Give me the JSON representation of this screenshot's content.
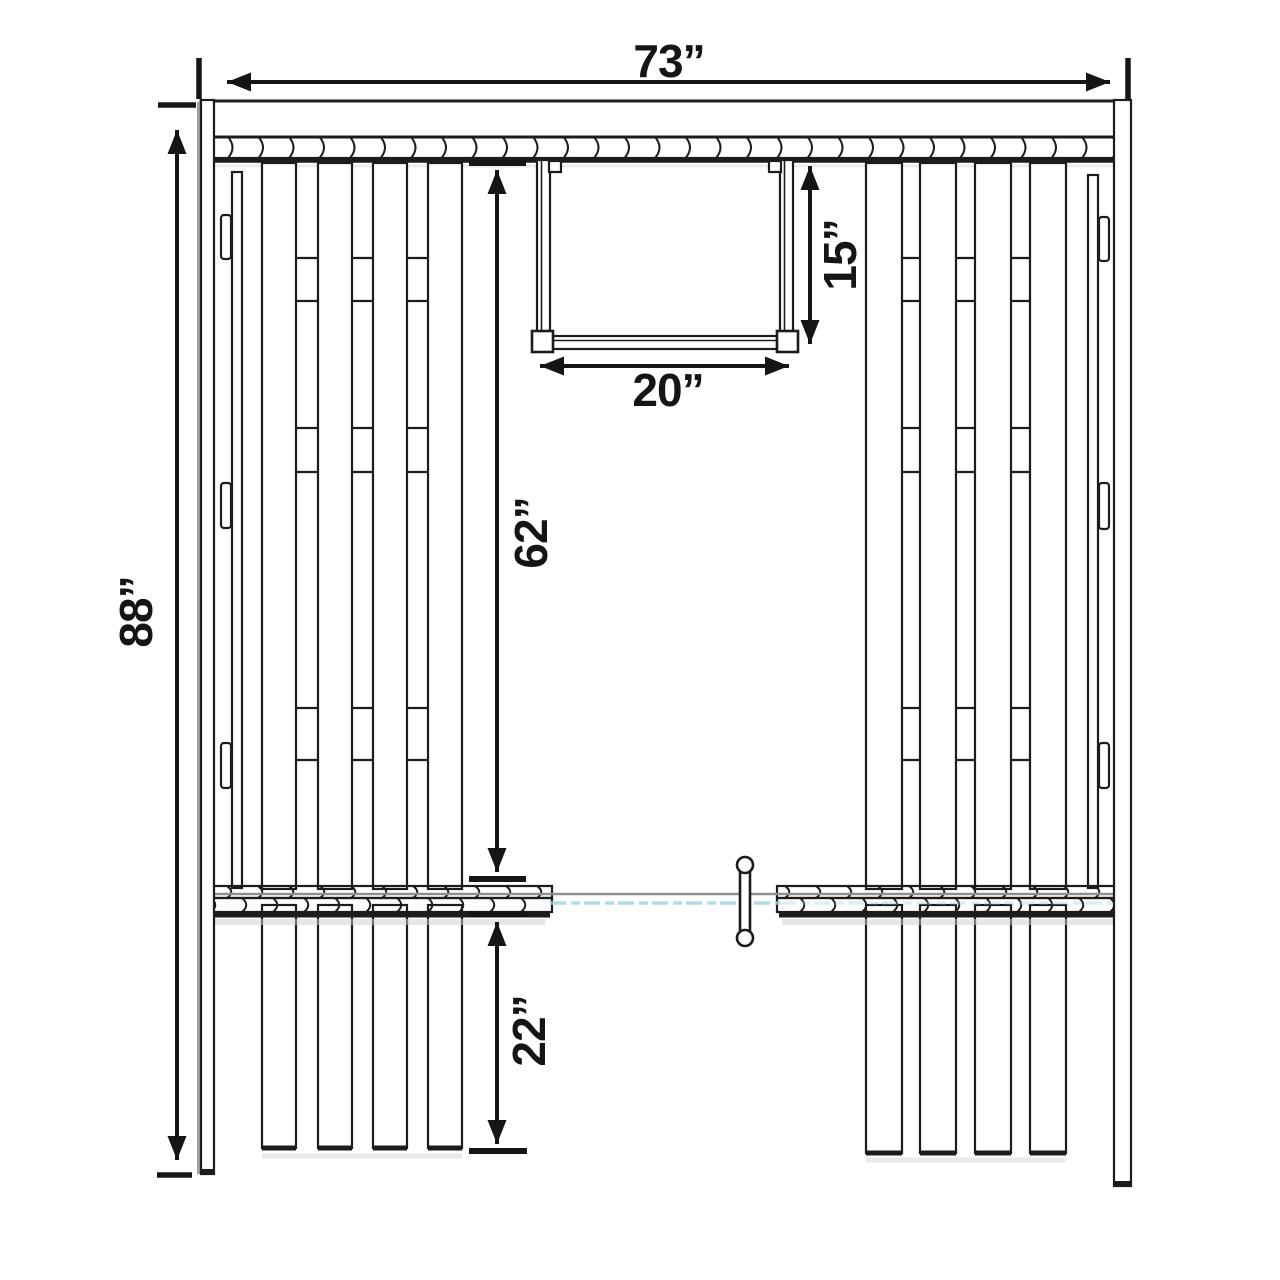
{
  "diagram": {
    "dimensions": {
      "overall_width": "73”",
      "overall_height": "88”",
      "upper_section_height": "62”",
      "lower_section_height": "22”",
      "window_height": "15”",
      "window_width": "20”"
    },
    "colors": {
      "line": "#1c1c1c",
      "dimension": "#151515",
      "post_shadow_gray": "#a0a0a0",
      "glass_gray": "#8f8f8f",
      "glass_blue": "#9ed2e4",
      "background": "#ffffff"
    }
  }
}
